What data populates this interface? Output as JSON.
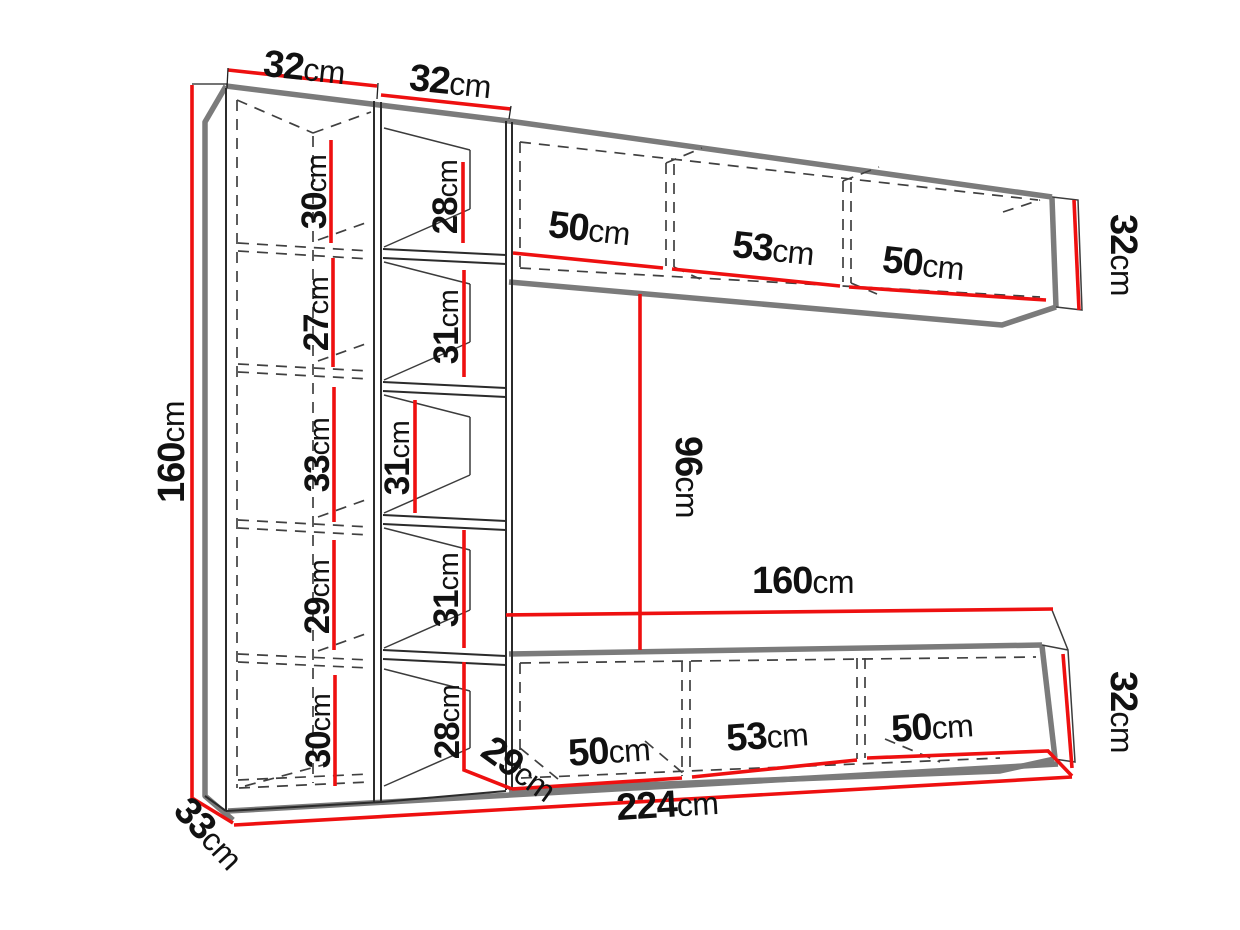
{
  "meta": {
    "description": "Technical dimension diagram of a wall unit: tall bookcase with two columns, upper wall shelf and lower TV cabinet",
    "unit": "cm"
  },
  "colors": {
    "dimension_line": "#ee1010",
    "structure_thick": "#7b7b7b",
    "structure_edge": "#2b2b2b",
    "hidden_line": "#404040",
    "label_text": "#111111",
    "background": "#ffffff"
  },
  "dims": {
    "col_a_width": {
      "value": "32",
      "unit": "cm"
    },
    "col_b_width": {
      "value": "32",
      "unit": "cm"
    },
    "unit_height": {
      "value": "160",
      "unit": "cm"
    },
    "col_a_sections": [
      {
        "value": "30",
        "unit": "cm"
      },
      {
        "value": "27",
        "unit": "cm"
      },
      {
        "value": "33",
        "unit": "cm"
      },
      {
        "value": "29",
        "unit": "cm"
      },
      {
        "value": "30",
        "unit": "cm"
      }
    ],
    "col_b_sections": [
      {
        "value": "28",
        "unit": "cm"
      },
      {
        "value": "31",
        "unit": "cm"
      },
      {
        "value": "31",
        "unit": "cm"
      },
      {
        "value": "31",
        "unit": "cm"
      },
      {
        "value": "28",
        "unit": "cm"
      }
    ],
    "top_shelf_sections": [
      {
        "value": "50",
        "unit": "cm"
      },
      {
        "value": "53",
        "unit": "cm"
      },
      {
        "value": "50",
        "unit": "cm"
      }
    ],
    "top_shelf_height": {
      "value": "32",
      "unit": "cm"
    },
    "middle_gap_height": {
      "value": "96",
      "unit": "cm"
    },
    "bottom_cabinet_width": {
      "value": "160",
      "unit": "cm"
    },
    "bottom_cabinet_sections": [
      {
        "value": "50",
        "unit": "cm"
      },
      {
        "value": "53",
        "unit": "cm"
      },
      {
        "value": "50",
        "unit": "cm"
      }
    ],
    "bottom_cabinet_height": {
      "value": "32",
      "unit": "cm"
    },
    "bottom_cabinet_depth": {
      "value": "29",
      "unit": "cm"
    },
    "total_width": {
      "value": "224",
      "unit": "cm"
    },
    "left_unit_depth": {
      "value": "33",
      "unit": "cm"
    }
  }
}
